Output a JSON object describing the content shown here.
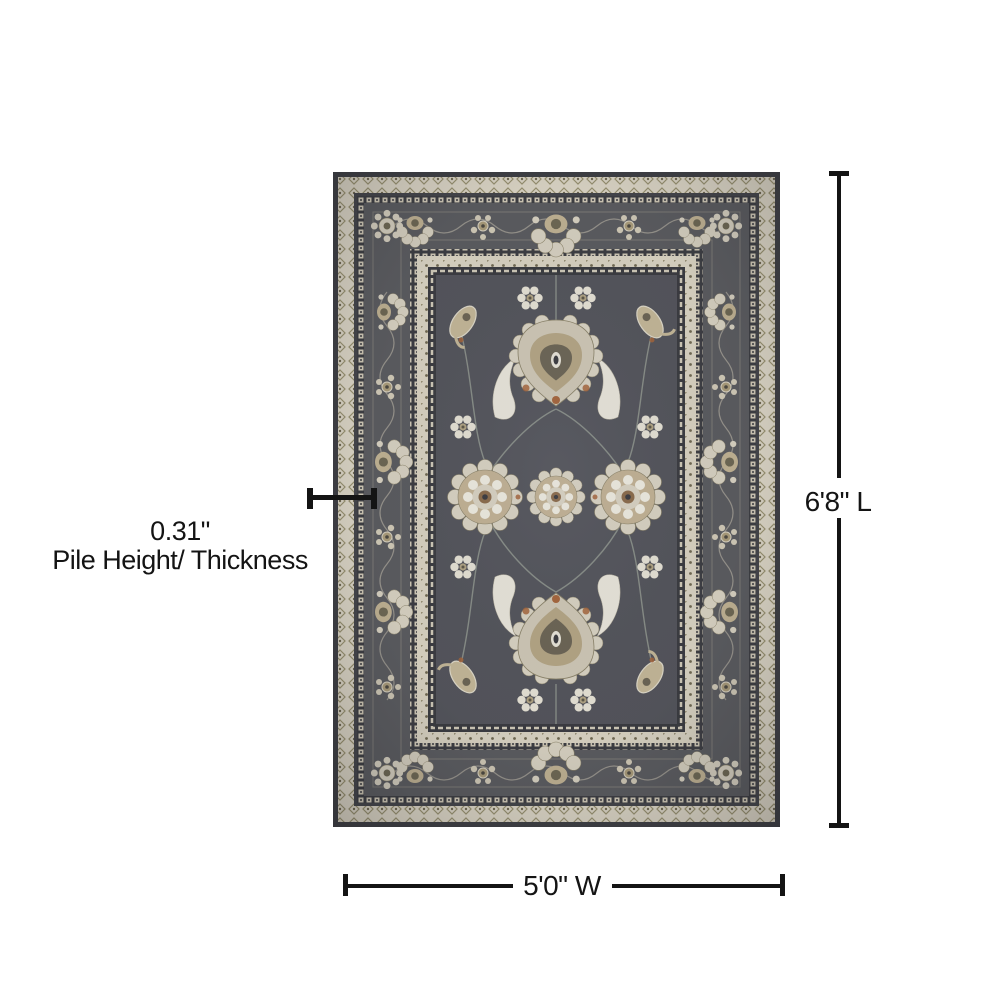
{
  "image": {
    "background_color": "#ffffff",
    "dimension_line_color": "#141414"
  },
  "rug": {
    "palette": {
      "field": "#53545b",
      "border_band": "#5a5b5f",
      "cream": "#dcd6c6",
      "ivory": "#e9e6db",
      "tan": "#c2b294",
      "rust": "#a5643a",
      "outline_dark": "#3e3f44"
    }
  },
  "annotations": {
    "length": {
      "label": "6'8\" L"
    },
    "width": {
      "label": "5'0\" W"
    },
    "pile_height": {
      "value": "0.31\"",
      "label": "Pile Height/ Thickness"
    }
  }
}
